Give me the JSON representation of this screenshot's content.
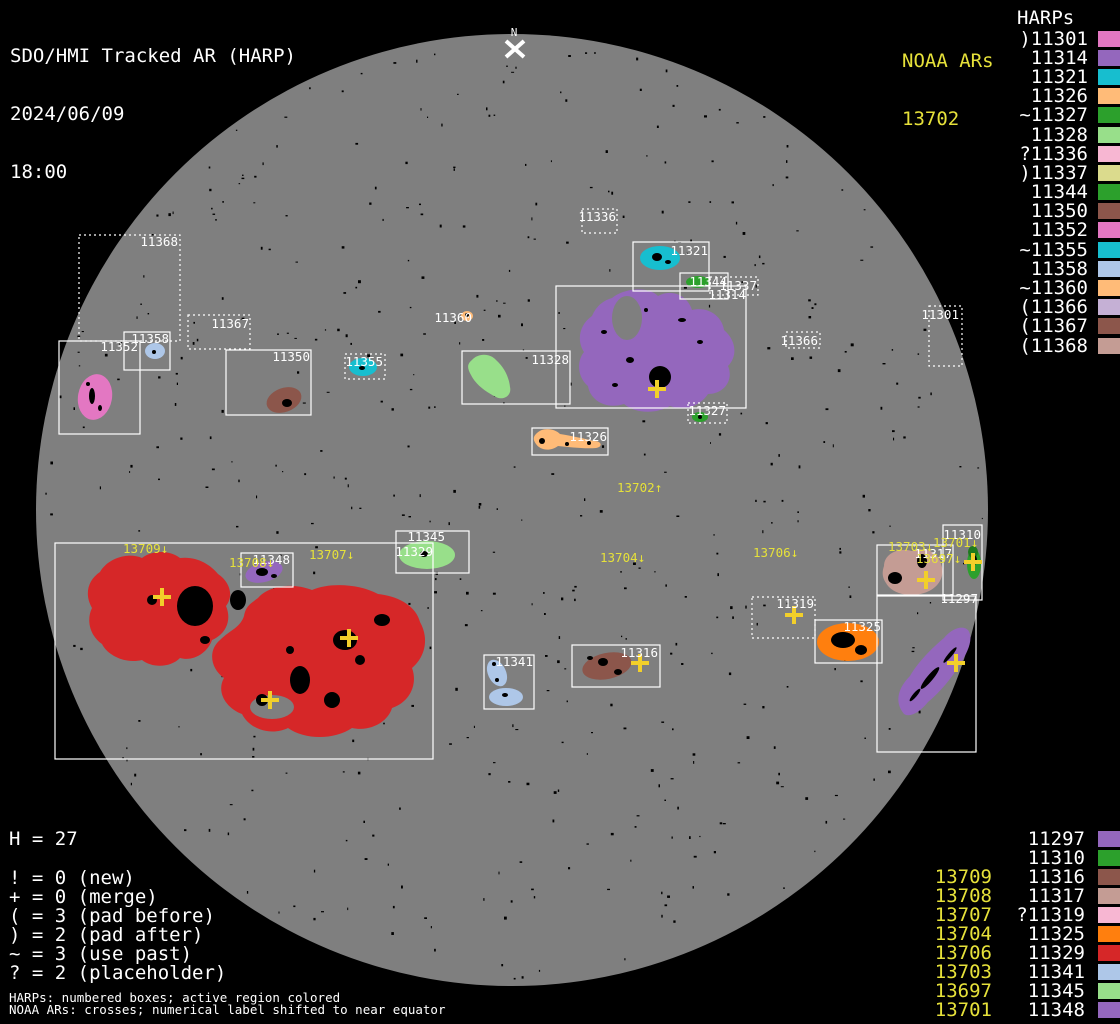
{
  "header": {
    "title": "SDO/HMI Tracked AR (HARP)",
    "date": "2024/06/09",
    "time": "18:00"
  },
  "noaa_top": {
    "header": "NOAA ARs",
    "value": "13702"
  },
  "harps_header": "HARPs",
  "colors": {
    "background": "#000000",
    "disk": "#7f7f7f",
    "white": "#ffffff",
    "noaa_yellow": "#e6e13a",
    "cross_yellow": "#f2cf2a"
  },
  "harp_list": [
    {
      "label": ")11301",
      "color": "#e377c2"
    },
    {
      "label": "11314",
      "color": "#9467bd"
    },
    {
      "label": "11321",
      "color": "#17becf"
    },
    {
      "label": "11326",
      "color": "#ffbb78"
    },
    {
      "label": "~11327",
      "color": "#2ca02c"
    },
    {
      "label": "11328",
      "color": "#98df8a"
    },
    {
      "label": "?11336",
      "color": "#f7b6d2"
    },
    {
      "label": ")11337",
      "color": "#dbdb8d"
    },
    {
      "label": "11344",
      "color": "#2ca02c"
    },
    {
      "label": "11350",
      "color": "#8c564b"
    },
    {
      "label": "11352",
      "color": "#e377c2"
    },
    {
      "label": "~11355",
      "color": "#17becf"
    },
    {
      "label": "11358",
      "color": "#aec7e8"
    },
    {
      "label": "~11360",
      "color": "#ffbb78"
    },
    {
      "label": "(11366",
      "color": "#c5b0d5"
    },
    {
      "label": "(11367",
      "color": "#8c564b"
    },
    {
      "label": "(11368",
      "color": "#c49c94"
    }
  ],
  "bottom_rows": [
    {
      "noaa": "",
      "harp": "11297",
      "color": "#9467bd"
    },
    {
      "noaa": "",
      "harp": "11310",
      "color": "#2ca02c"
    },
    {
      "noaa": "13709",
      "harp": "11316",
      "color": "#8c564b"
    },
    {
      "noaa": "13708",
      "harp": "11317",
      "color": "#c49c94"
    },
    {
      "noaa": "13707",
      "harp": "?11319",
      "color": "#f7b6d2"
    },
    {
      "noaa": "13704",
      "harp": "11325",
      "color": "#ff7f0e"
    },
    {
      "noaa": "13706",
      "harp": "11329",
      "color": "#d62728"
    },
    {
      "noaa": "13703",
      "harp": "11341",
      "color": "#aec7e8"
    },
    {
      "noaa": "13697",
      "harp": "11345",
      "color": "#98df8a"
    },
    {
      "noaa": "13701",
      "harp": "11348",
      "color": "#9467bd"
    }
  ],
  "legend": {
    "h_line": "H = 27",
    "lines": [
      "! = 0 (new)",
      "+ = 0 (merge)",
      "( = 3 (pad before)",
      ") = 2 (pad after)",
      "~ = 3 (use past)",
      "? = 2 (placeholder)"
    ],
    "foot1": "HARPs: numbered boxes; active region colored",
    "foot2": "NOAA ARs: crosses; numerical label shifted to near equator"
  },
  "disk": {
    "cx": 512,
    "cy": 510,
    "r": 476,
    "fill": "#7f7f7f",
    "north_label": "N",
    "regions": [
      {
        "c": "#d62728",
        "p": "M100,572 C108,558 128,552 142,558 C152,550 170,550 180,558 C196,556 210,564 218,574 C230,582 234,596 226,606 C232,620 226,634 212,640 C208,652 194,662 180,658 C170,668 152,668 142,660 C126,664 108,656 102,644 C90,636 86,620 92,608 C84,594 88,580 100,572 Z"
      },
      {
        "c": "#d62728",
        "p": "M258,598 C268,586 292,582 312,590 C330,582 360,584 378,594 C398,596 416,606 420,622 C430,640 424,658 412,668 C418,684 410,702 392,708 C388,722 370,732 352,728 C334,740 305,740 288,728 C272,736 250,730 242,714 C226,708 216,692 224,678 C210,668 208,650 220,640 C230,630 240,628 244,616 C246,606 250,604 258,598 Z"
      },
      {
        "c": "#9467bd",
        "p": "M612,298 C624,288 648,286 658,296 C672,288 688,296 692,310 C708,306 722,316 724,330 C736,340 738,356 728,366 C734,380 724,394 708,394 C700,406 684,412 670,406 C656,414 636,414 624,404 C606,410 590,400 588,386 C578,378 576,362 584,352 C576,340 580,324 592,316 C596,306 604,300 612,298 Z"
      },
      {
        "c": "#e377c2",
        "e": [
          95,
          397,
          17,
          23,
          10
        ]
      },
      {
        "c": "#aec7e8",
        "e": [
          155,
          351,
          10,
          8,
          0
        ]
      },
      {
        "c": "#8c564b",
        "e": [
          284,
          400,
          18,
          12,
          -20
        ]
      },
      {
        "c": "#17becf",
        "e": [
          363,
          367,
          14,
          9,
          0
        ]
      },
      {
        "c": "#98df8a",
        "p": "M472,360 C478,353 490,353 496,360 C504,367 509,377 510,387 C512,395 504,401 496,397 C486,392 476,385 471,375 C467,368 467,364 472,360 Z"
      },
      {
        "c": "#17becf",
        "e": [
          660,
          258,
          20,
          12,
          0
        ]
      },
      {
        "c": "#2ca02c",
        "e": [
          698,
          282,
          12,
          6,
          0
        ]
      },
      {
        "c": "#2ca02c",
        "e": [
          700,
          417,
          8,
          5,
          0
        ]
      },
      {
        "c": "#ffbb78",
        "e": [
          467,
          316,
          6,
          5,
          0
        ]
      },
      {
        "c": "#ffbb78",
        "p": "M536,434 C542,427 554,428 560,434 C572,436 586,439 594,441 C602,441 603,447 596,448 C584,449 570,447 558,446 C550,452 540,450 536,444 C533,440 533,437 536,434 Z"
      },
      {
        "c": "#98df8a",
        "e": [
          427,
          555,
          28,
          14,
          0
        ]
      },
      {
        "c": "#9467bd",
        "e": [
          264,
          572,
          19,
          10,
          -15
        ]
      },
      {
        "c": "#c49c94",
        "p": "M884,566 C884,554 898,547 912,551 C926,546 939,553 941,564 C946,576 938,589 924,593 C910,598 892,594 886,583 C882,577 882,572 884,566 Z"
      },
      {
        "c": "#2ca02c",
        "e": [
          974,
          564,
          7,
          15,
          0
        ]
      },
      {
        "c": "#1e7a1e",
        "e": [
          973,
          552,
          5,
          6,
          0
        ]
      },
      {
        "c": "#9467bd",
        "p": "M904,714 C894,702 898,688 910,676 C918,662 932,648 944,638 C950,630 962,624 968,630 C974,638 968,652 960,664 C952,678 940,692 928,702 C920,712 910,718 904,714 Z"
      },
      {
        "c": "#ff7f0e",
        "e": [
          848,
          642,
          31,
          19,
          0
        ]
      },
      {
        "c": "#aec7e8",
        "e": [
          497,
          673,
          9,
          14,
          -25
        ]
      },
      {
        "c": "#aec7e8",
        "e": [
          506,
          697,
          17,
          9,
          0
        ]
      },
      {
        "c": "#8c564b",
        "e": [
          607,
          666,
          25,
          13,
          -12
        ]
      }
    ],
    "holes": [
      [
        627,
        318,
        15,
        22
      ],
      [
        272,
        707,
        22,
        12
      ]
    ],
    "spots": [
      [
        195,
        606,
        18,
        20,
        0
      ],
      [
        238,
        600,
        8,
        10,
        0
      ],
      [
        152,
        600,
        5,
        5,
        0
      ],
      [
        205,
        640,
        5,
        4,
        0
      ],
      [
        345,
        640,
        12,
        10,
        0
      ],
      [
        300,
        680,
        10,
        14,
        0
      ],
      [
        262,
        700,
        6,
        6,
        0
      ],
      [
        382,
        620,
        8,
        6,
        0
      ],
      [
        332,
        700,
        8,
        8,
        0
      ],
      [
        360,
        660,
        5,
        5,
        0
      ],
      [
        290,
        650,
        4,
        4,
        0
      ],
      [
        660,
        377,
        11,
        11,
        0
      ],
      [
        630,
        360,
        4,
        3,
        0
      ],
      [
        604,
        332,
        3,
        2,
        0
      ],
      [
        682,
        320,
        4,
        2,
        0
      ],
      [
        646,
        310,
        2,
        2,
        0
      ],
      [
        700,
        342,
        3,
        2,
        0
      ],
      [
        615,
        385,
        3,
        2,
        0
      ],
      [
        895,
        578,
        7,
        6,
        0
      ],
      [
        922,
        561,
        5,
        7,
        0
      ],
      [
        843,
        640,
        12,
        8,
        0
      ],
      [
        861,
        650,
        6,
        5,
        0
      ],
      [
        657,
        257,
        5,
        4,
        0
      ],
      [
        668,
        262,
        3,
        2,
        0
      ],
      [
        262,
        572,
        6,
        4,
        0
      ],
      [
        274,
        576,
        3,
        2,
        0
      ],
      [
        424,
        554,
        4,
        3,
        0
      ],
      [
        603,
        662,
        5,
        4,
        0
      ],
      [
        618,
        672,
        4,
        3,
        0
      ],
      [
        590,
        658,
        3,
        2,
        0
      ],
      [
        497,
        680,
        2,
        2,
        0
      ],
      [
        505,
        695,
        3,
        2,
        0
      ],
      [
        494,
        664,
        2,
        2,
        0
      ],
      [
        92,
        396,
        3,
        8,
        0
      ],
      [
        100,
        408,
        2,
        3,
        0
      ],
      [
        88,
        384,
        2,
        2,
        0
      ],
      [
        287,
        403,
        5,
        4,
        0
      ],
      [
        974,
        560,
        3,
        5,
        0
      ],
      [
        362,
        368,
        3,
        2,
        0
      ],
      [
        154,
        352,
        2,
        2,
        0
      ],
      [
        700,
        417,
        2,
        2,
        0
      ],
      [
        542,
        441,
        3,
        3,
        0
      ],
      [
        567,
        444,
        2,
        2,
        0
      ],
      [
        589,
        443,
        2,
        2,
        0
      ],
      [
        930,
        678,
        3,
        14,
        40
      ],
      [
        950,
        655,
        2,
        10,
        40
      ],
      [
        915,
        695,
        2,
        8,
        40
      ],
      [
        467,
        315,
        2,
        2,
        0
      ]
    ],
    "boxes": [
      {
        "id": "11368",
        "x": 79,
        "y": 235,
        "w": 101,
        "h": 106,
        "dotted": true,
        "lx": 178,
        "ly": 246
      },
      {
        "id": "11367",
        "x": 188,
        "y": 315,
        "w": 62,
        "h": 34,
        "dotted": true,
        "lx": 249,
        "ly": 328
      },
      {
        "id": "11352",
        "x": 59,
        "y": 341,
        "w": 81,
        "h": 93,
        "dotted": false,
        "lx": 138,
        "ly": 351
      },
      {
        "id": "11358",
        "x": 124,
        "y": 332,
        "w": 46,
        "h": 38,
        "dotted": false,
        "lx": 169,
        "ly": 343
      },
      {
        "id": "11350",
        "x": 226,
        "y": 350,
        "w": 85,
        "h": 65,
        "dotted": false,
        "lx": 310,
        "ly": 361
      },
      {
        "id": "11355",
        "x": 345,
        "y": 354,
        "w": 40,
        "h": 25,
        "dotted": true,
        "lx": 383,
        "ly": 366
      },
      {
        "id": "11328",
        "x": 462,
        "y": 351,
        "w": 108,
        "h": 53,
        "dotted": false,
        "lx": 569,
        "ly": 364
      },
      {
        "id": "11336",
        "x": 582,
        "y": 209,
        "w": 35,
        "h": 24,
        "dotted": true,
        "lx": 616,
        "ly": 221
      },
      {
        "id": "11321",
        "x": 633,
        "y": 242,
        "w": 76,
        "h": 49,
        "dotted": false,
        "lx": 708,
        "ly": 255
      },
      {
        "id": "11344",
        "x": 680,
        "y": 273,
        "w": 48,
        "h": 26,
        "dotted": false,
        "lx": 727,
        "ly": 286
      },
      {
        "id": "11337",
        "x": 710,
        "y": 277,
        "w": 48,
        "h": 18,
        "dotted": true,
        "lx": 757,
        "ly": 290
      },
      {
        "id": "11314",
        "x": 556,
        "y": 286,
        "w": 190,
        "h": 122,
        "dotted": false,
        "lx": 746,
        "ly": 299
      },
      {
        "id": "11366",
        "x": 786,
        "y": 332,
        "w": 34,
        "h": 16,
        "dotted": true,
        "lx": 818,
        "ly": 345
      },
      {
        "id": "11327",
        "x": 688,
        "y": 403,
        "w": 39,
        "h": 20,
        "dotted": true,
        "lx": 726,
        "ly": 415
      },
      {
        "id": "11326",
        "x": 532,
        "y": 428,
        "w": 76,
        "h": 27,
        "dotted": false,
        "lx": 607,
        "ly": 441
      },
      {
        "id": "11301",
        "x": 929,
        "y": 306,
        "w": 33,
        "h": 60,
        "dotted": true,
        "lx": 959,
        "ly": 319
      },
      {
        "id": "11345",
        "x": 396,
        "y": 531,
        "w": 73,
        "h": 42,
        "dotted": false,
        "lx": 445,
        "ly": 541
      },
      {
        "id": "11348",
        "x": 241,
        "y": 553,
        "w": 52,
        "h": 34,
        "dotted": false,
        "lx": 290,
        "ly": 564
      },
      {
        "id": "11329",
        "x": 55,
        "y": 543,
        "w": 378,
        "h": 216,
        "dotted": false,
        "lx": 433,
        "ly": 556
      },
      {
        "id": "11319",
        "x": 752,
        "y": 597,
        "w": 63,
        "h": 41,
        "dotted": true,
        "lx": 814,
        "ly": 608
      },
      {
        "id": "11317",
        "x": 877,
        "y": 545,
        "w": 76,
        "h": 50,
        "dotted": false,
        "lx": 952,
        "ly": 558
      },
      {
        "id": "11310",
        "x": 943,
        "y": 525,
        "w": 39,
        "h": 75,
        "dotted": false,
        "lx": 981,
        "ly": 539
      },
      {
        "id": "11297",
        "x": 877,
        "y": 596,
        "w": 99,
        "h": 156,
        "dotted": false,
        "lx": 978,
        "ly": 603
      },
      {
        "id": "11325",
        "x": 815,
        "y": 620,
        "w": 67,
        "h": 43,
        "dotted": false,
        "lx": 881,
        "ly": 631
      },
      {
        "id": "11341",
        "x": 484,
        "y": 655,
        "w": 50,
        "h": 54,
        "dotted": false,
        "lx": 533,
        "ly": 666
      },
      {
        "id": "11316",
        "x": 572,
        "y": 645,
        "w": 88,
        "h": 42,
        "dotted": false,
        "lx": 658,
        "ly": 657
      }
    ],
    "floating_labels": [
      {
        "t": "11360",
        "x": 472,
        "y": 322
      }
    ],
    "noaa_labels": [
      {
        "t": "13702↑",
        "x": 617,
        "y": 492
      },
      {
        "t": "13704↓",
        "x": 600,
        "y": 562
      },
      {
        "t": "13706↓",
        "x": 753,
        "y": 557
      },
      {
        "t": "13709↓",
        "x": 123,
        "y": 553
      },
      {
        "t": "13708↓",
        "x": 229,
        "y": 567
      },
      {
        "t": "13707↓",
        "x": 309,
        "y": 559
      },
      {
        "t": "13703↓",
        "x": 888,
        "y": 551
      },
      {
        "t": "13701↓",
        "x": 933,
        "y": 547
      },
      {
        "t": "13697↓",
        "x": 916,
        "y": 563
      }
    ],
    "crosses": [
      [
        657,
        389
      ],
      [
        162,
        597
      ],
      [
        349,
        638
      ],
      [
        270,
        700
      ],
      [
        794,
        615
      ],
      [
        926,
        580
      ],
      [
        973,
        562
      ],
      [
        956,
        663
      ],
      [
        640,
        663
      ]
    ]
  }
}
